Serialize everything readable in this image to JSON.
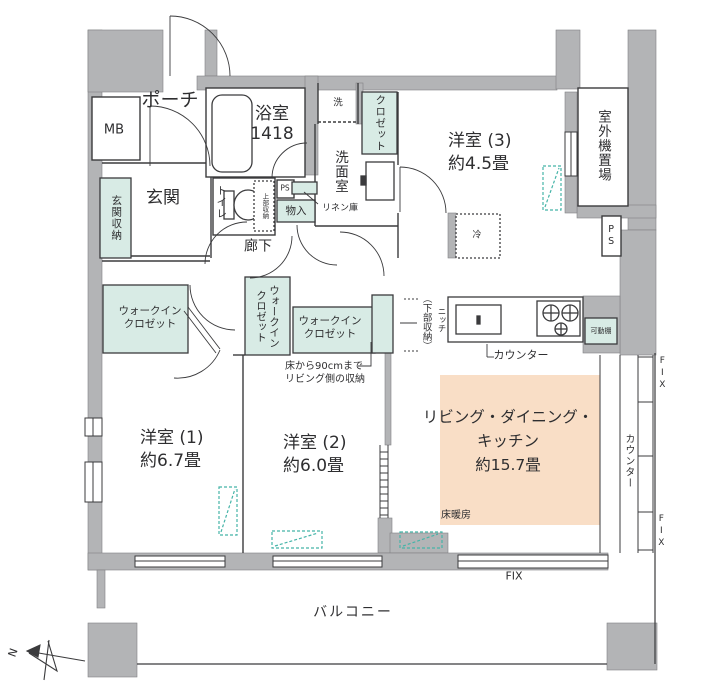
{
  "colors": {
    "wall": "#b3b4b6",
    "storage_fill": "#d8ebe5",
    "ldk_highlight": "#f9dec6",
    "marker_teal": "#45b4a8",
    "line": "#3b3b3d"
  },
  "labels": {
    "porch": "ポーチ",
    "mb": "MB",
    "bathroom_name": "浴室",
    "bathroom_size": "1418",
    "washer": "洗",
    "closet": "クロゼット",
    "western3_name": "洋室 (3)",
    "western3_size": "約4.5畳",
    "outdoor_unit": "室外機置場",
    "entrance": "玄関",
    "entrance_storage": "玄関収納",
    "toilet": "トイレ",
    "upper_storage": "上部収納",
    "ps_top": "PS",
    "ps_right": "PS",
    "storage_small": "物入",
    "washroom": "洗面室",
    "linen": "リネン庫",
    "hallway": "廊下",
    "fridge": "冷",
    "wic_left_line1": "ウォークイン",
    "wic_left_line2": "クロゼット",
    "wic_middle_line1": "ウォークイン",
    "wic_middle_line2": "クロゼット",
    "wic_right_line1": "ウォークイン",
    "wic_right_line2": "クロゼット",
    "lower_storage": "（下部収納）",
    "niche": "ニッチ",
    "kitchen_counter": "カウンター",
    "movable_shelf": "可動棚",
    "storage_note_line1": "床から90cmまで",
    "storage_note_line2": "リビング側の収納",
    "western1_name": "洋室 (1)",
    "western1_size": "約6.7畳",
    "western2_name": "洋室 (2)",
    "western2_size": "約6.0畳",
    "ldk_line1": "リビング・ダイニング・",
    "ldk_line2": "キッチン",
    "ldk_line3": "約15.7畳",
    "floor_heating": "床暖房",
    "side_counter": "カウンター",
    "fix_right_top": "FIX",
    "fix_right_bottom": "FIX",
    "fix_bottom": "FIX",
    "balcony": "バルコニー",
    "north": "N"
  }
}
